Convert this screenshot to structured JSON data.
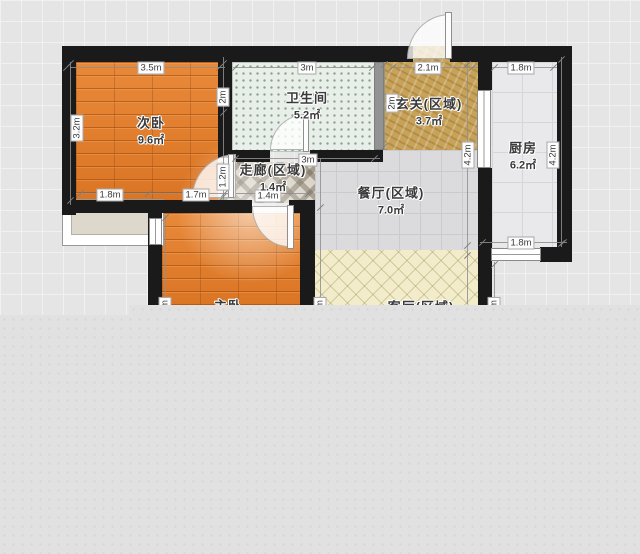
{
  "floorplan": {
    "rooms": [
      {
        "id": "bedroom2",
        "name": "次卧",
        "area": "9.6㎡"
      },
      {
        "id": "bathroom",
        "name": "卫生间",
        "area": "5.2㎡"
      },
      {
        "id": "entry",
        "name": "玄关(区域)",
        "area": "3.7㎡"
      },
      {
        "id": "kitchen",
        "name": "厨房",
        "area": "6.2㎡"
      },
      {
        "id": "corridor",
        "name": "走廊(区域)",
        "area": "1.4㎡"
      },
      {
        "id": "dining",
        "name": "餐厅(区域)",
        "area": "7.0㎡"
      },
      {
        "id": "bedroom1",
        "name": "主卧",
        "area": ""
      },
      {
        "id": "living",
        "name": "客厅(区域)",
        "area": ""
      }
    ],
    "dimensions": [
      {
        "label": "3.5m"
      },
      {
        "label": "3.2m"
      },
      {
        "label": "2m"
      },
      {
        "label": "1.2m"
      },
      {
        "label": "1.8m"
      },
      {
        "label": "1.7m"
      },
      {
        "label": "3m"
      },
      {
        "label": "3m"
      },
      {
        "label": "2m"
      },
      {
        "label": "2.1m"
      },
      {
        "label": "1.8m"
      },
      {
        "label": "4.2m"
      },
      {
        "label": "4.2m"
      },
      {
        "label": "1.8m"
      },
      {
        "label": "1.4m"
      },
      {
        "label": "m"
      },
      {
        "label": "m"
      },
      {
        "label": "m"
      }
    ],
    "colors": {
      "wall": "#1a1a1a",
      "wood_floor": "#de7c2a",
      "bath_tile": "#e8efe9",
      "entry_marble": "#c7a258",
      "kitchen_tile": "#e9e9ec",
      "dining_tile": "#dbdbde",
      "corridor_tile": "#d8d2c6",
      "living_tile": "#f2ecca",
      "canvas_background": "#e5e5e5"
    }
  }
}
